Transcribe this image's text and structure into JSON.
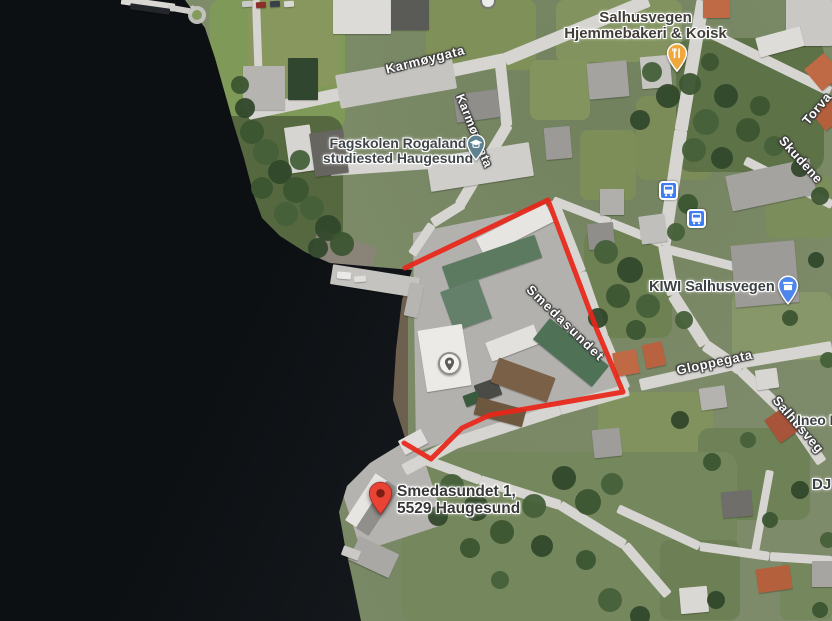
{
  "street_labels": {
    "karmoygata_h": "Karmøygata",
    "karmoygata_v": "Karmøygata",
    "smedasundet": "Smedasundet",
    "gloppegata": "Gloppegata",
    "torvastadgata": "Torva",
    "skudenesgata": "Skudene",
    "salhusvegen": "Salhusveg"
  },
  "poi": {
    "bakery": {
      "line1": "Salhusvegen",
      "line2": "Hjemmebakeri & Koisk"
    },
    "fagskolen": {
      "line1": "Fagskolen Rogaland",
      "line2": "studiested Haugesund"
    },
    "kiwi": {
      "label": "KIWI Salhusvegen"
    },
    "ineo": {
      "label": "Ineo H"
    },
    "dj": {
      "label": "DJ"
    }
  },
  "marker": {
    "line1": "Smedasundet 1,",
    "line2": "5529 Haugesund"
  },
  "overlay": {
    "outline_points": "405,268 548,200 597,330 623,392 560,403 490,415 462,428 431,459 404,443",
    "outline_color": "#e82619"
  },
  "icons": {
    "restaurant_pin": "fork-knife-pin",
    "school_pin": "graduation-cap-pin",
    "grocery_pin": "storefront-pin",
    "bus_stop": "bus-icon",
    "place_circle": "map-pin-circle",
    "destination_pin": "red-map-pin"
  },
  "colors": {
    "outline_red": "#e82619",
    "water": "#121519",
    "road": "#d6d5d1",
    "restaurant_pin": "#f0a73c",
    "school_pin": "#5f8290",
    "grocery_pin": "#4f86ec",
    "bus_icon": "#3f7df2",
    "destination_pin": "#e94335",
    "street_label_text": "#fdfdfd",
    "poi_label_text": "#3f4246",
    "address_label_text": "#373737"
  }
}
